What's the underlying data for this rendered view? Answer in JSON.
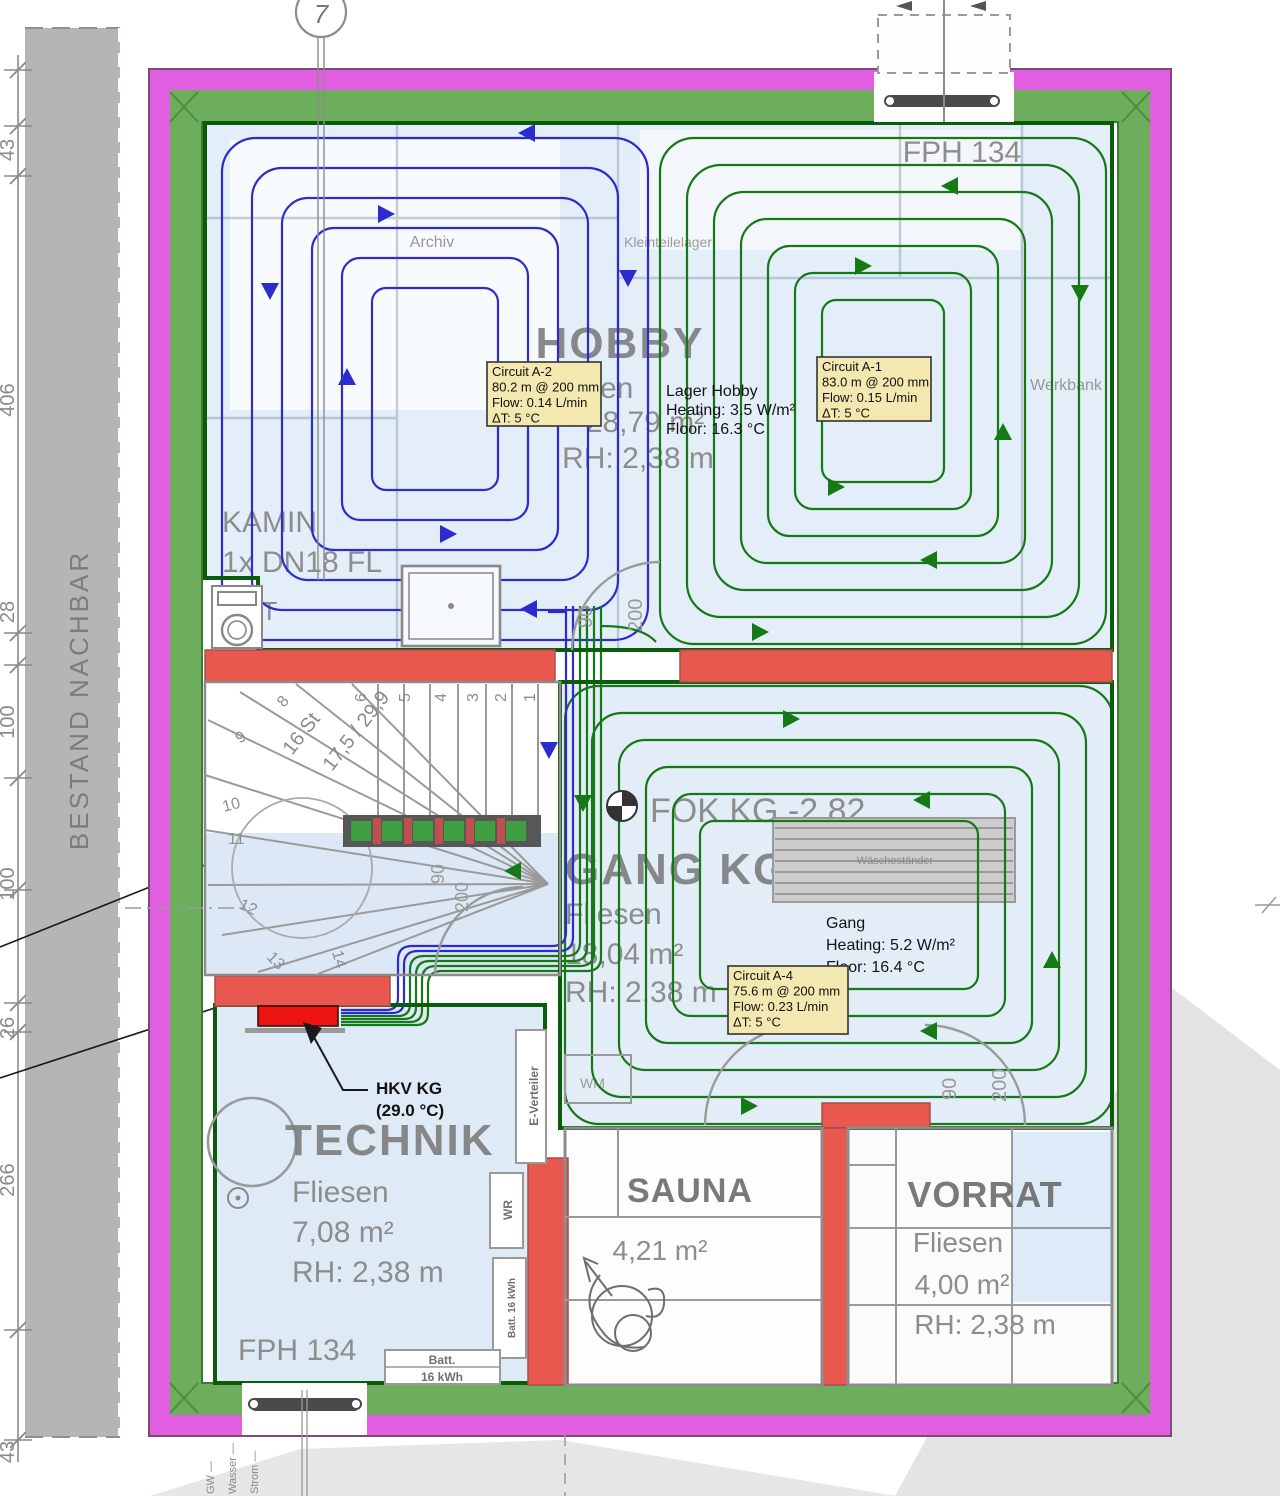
{
  "axis": {
    "label": "7"
  },
  "neighbor": {
    "label": "BESTAND NACHBAR"
  },
  "dimensions": {
    "left": [
      "43",
      "406",
      "28",
      "100",
      "100",
      "26",
      "266",
      "43"
    ]
  },
  "hobby": {
    "name": "HOBBY",
    "fph": "FPH 134",
    "archiv": "Archiv",
    "kleinteilelager": "Kleinteilelager",
    "werkbank": "Werkbank",
    "floor": "Fliesen",
    "area": "28,79 m²",
    "rh": "RH: 2,38 m",
    "kamin_line1": "KAMIN",
    "kamin_line2": "1x DN18 FL",
    "pt": "PT"
  },
  "gang": {
    "fok": "FOK KG -2,82",
    "name": "GANG KG",
    "floor": "Fliesen",
    "area": "18,04 m²",
    "rh": "RH: 2,38 m",
    "wm": "WM",
    "rack": "Wäscheständer"
  },
  "technik": {
    "name": "TECHNIK",
    "floor": "Fliesen",
    "area": "7,08 m²",
    "rh": "RH: 2,38 m",
    "fph": "FPH 134",
    "e_verteiler": "E-Verteiler",
    "wr": "WR",
    "batt_v": "Batt. 16 kWh",
    "batt_h1": "Batt.",
    "batt_h2": "16 kWh"
  },
  "sauna": {
    "name": "SAUNA",
    "area": "4,21 m²"
  },
  "vorrat": {
    "name": "VORRAT",
    "floor": "Fliesen",
    "area": "4,00 m²",
    "rh": "RH: 2,38 m"
  },
  "hkv": {
    "line1": "HKV KG",
    "line2": "(29.0 °C)"
  },
  "circuits": [
    {
      "id": "a2",
      "title": "Circuit A-2",
      "length": "80.2 m @ 200 mm",
      "flow": "Flow: 0.14 L/min",
      "dt": "ΔT: 5 °C"
    },
    {
      "id": "a1",
      "title": "Circuit A-1",
      "length": "83.0 m @ 200 mm",
      "flow": "Flow: 0.15 L/min",
      "dt": "ΔT: 5 °C"
    },
    {
      "id": "a4",
      "title": "Circuit A-4",
      "length": "75.6 m @ 200 mm",
      "flow": "Flow: 0.23 L/min",
      "dt": "ΔT: 5 °C"
    }
  ],
  "stats": [
    {
      "id": "lager",
      "lines": [
        "Lager Hobby",
        "Heating: 3.5 W/m²",
        "Floor: 16.3 °C"
      ]
    },
    {
      "id": "gang",
      "lines": [
        "Gang",
        "Heating: 5.2 W/m²",
        "Floor: 16.4 °C"
      ]
    }
  ],
  "stairs": {
    "numbers": [
      "1",
      "2",
      "3",
      "4",
      "5",
      "6",
      "8",
      "9",
      "10",
      "11",
      "12",
      "13",
      "14"
    ],
    "count": "16 St",
    "ratio": "17,5 / 29,9"
  },
  "doors": {
    "width": "90",
    "height": "200"
  },
  "utilities": [
    "GW",
    "Wasser",
    "Strom"
  ],
  "colors": {
    "pipe_supply": "#2c2ccc",
    "pipe_return": "#157a15",
    "wall_accent": "#e8584f",
    "manifold": "#ee1511",
    "insulation": "#6cae5c",
    "moisture_barrier": "#e25fe2",
    "room_fill": "#e2edf8"
  }
}
